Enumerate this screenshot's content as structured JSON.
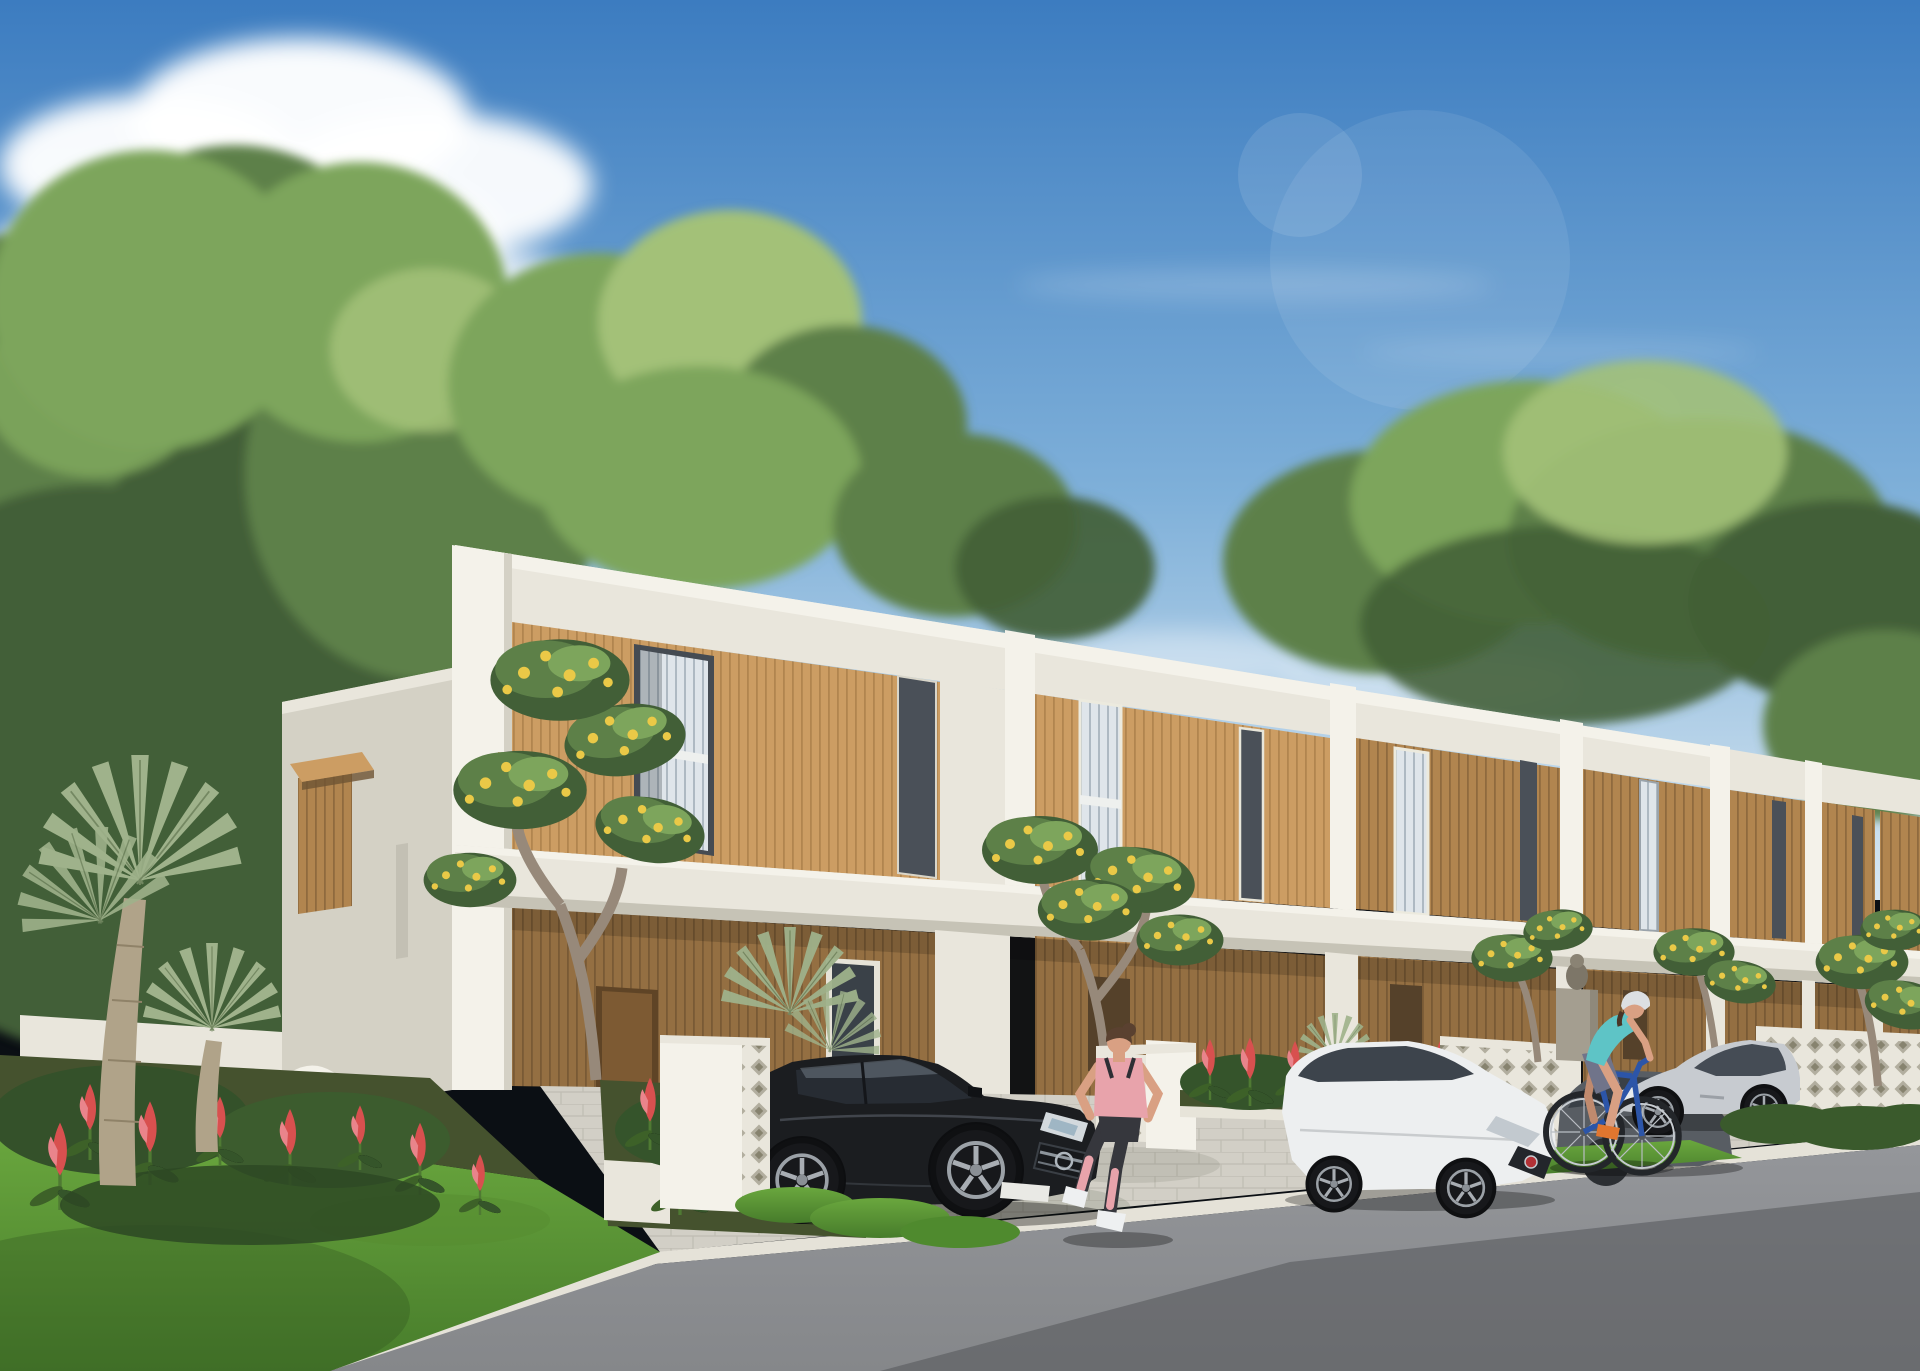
{
  "scene": {
    "type": "exterior architectural rendering",
    "description": "Sunny daytime 3D rendering of a row of modern two-storey tropical townhouses with white concrete frames and vertical timber-slat facades along an asphalt street. Cars are parked in the driveways, a woman jogs along the street and another woman cycles past on a blue bicycle. Dense green trees rise behind the houses under a blue sky with white clouds.",
    "sky": {
      "condition": "clear blue with scattered cumulus clouds upper-left and thin haze wisps near the horizon"
    },
    "architecture": {
      "style": "modern tropical minimalist townhouses",
      "storeys": 2,
      "visible_units": 7,
      "materials": [
        "white painted concrete frames",
        "vertical timber slat cladding",
        "tall windows with white vertical blinds",
        "white breeze-block fences",
        "light paver driveways"
      ]
    },
    "vehicles": [
      {
        "name": "black-suv",
        "type": "compact luxury SUV with chrome grille emblem",
        "color_name": "black",
        "location": "driveway of corner unit"
      },
      {
        "name": "white-sedan",
        "type": "subcompact sedan with red grille badge",
        "color_name": "white",
        "location": "driveway, nose toward street"
      },
      {
        "name": "gray-sedan",
        "type": "sedan",
        "color_name": "dark gray",
        "location": "driveway behind white sedan"
      },
      {
        "name": "silver-coupe",
        "type": "long-hood sports coupe",
        "color_name": "silver",
        "location": "driveway at right"
      }
    ],
    "people": [
      {
        "name": "jogger",
        "description": "woman jogging to the right, seen from behind: pink tank top, dark leggings with pink calf sleeves, white sneakers, brown hair in a bun"
      },
      {
        "name": "cyclist",
        "description": "woman riding a blue bicycle: white helmet, teal tank top, gray-violet shorts, orange shoes"
      }
    ],
    "vegetation": [
      {
        "name": "backdrop-canopy",
        "description": "tall dense green trees behind the whole row of houses"
      },
      {
        "name": "fan-palms",
        "description": "silver-green fan palms with thick trunks in the left garden"
      },
      {
        "name": "frangipani-trees",
        "description": "frangipani trees with yellow flower clusters in front of the units"
      },
      {
        "name": "red-ginger-beds",
        "description": "red ginger flowers in planting beds along walls and driveways"
      },
      {
        "name": "lawn",
        "description": "bright green lawn in the left foreground"
      }
    ],
    "street": {
      "surface": "dark asphalt with a large soft shadow across the lower right",
      "features": [
        "white curb edge",
        "paver driveways",
        "white breeze-block fence panels",
        "stone gate pillar with small statue"
      ]
    }
  },
  "colors": {
    "sky_top": "#3c7cc0",
    "sky_mid": "#7fb0d9",
    "sky_horizon": "#d9e8f2",
    "cloud": "#ffffff",
    "tree_dark": "#425f37",
    "tree_mid": "#5d8048",
    "tree_light": "#7da55c",
    "tree_pale": "#a3c178",
    "wall_sunlit": "#f4f2ea",
    "wall_white": "#e9e6dc",
    "wall_shade": "#d4d1c5",
    "wall_deep": "#bab7aa",
    "wood_light": "#cc9d63",
    "wood_mid": "#b1854f",
    "wood_dark": "#8f6a3e",
    "window_dark": "#4a5058",
    "blinds": "#dfe5ea",
    "road": "#85878a",
    "road_shadow": "#54565a",
    "curb": "#e5e2d8",
    "paver": "#d2cfc6",
    "lawn": "#6aa73e",
    "lawn_shade": "#477c2b",
    "soil": "#45522e",
    "palm": "#9fb28b",
    "trunk": "#b0a389",
    "flower_red": "#d8504f",
    "flower_yellow": "#eac947",
    "suv_black": "#1b1d20",
    "car_white": "#edeff0",
    "car_gray": "#585d63",
    "car_silver": "#c7cbd0",
    "skin": "#d9a083",
    "jogger_top": "#e8a3ab",
    "jogger_leggings": "#36373d",
    "shoe_white": "#eef0f1",
    "cyclist_top": "#5ec4c6",
    "cyclist_shorts": "#70748a",
    "helmet": "#dcdfe2",
    "shoe_orange": "#e0762f",
    "bike_blue": "#2c55a8"
  }
}
